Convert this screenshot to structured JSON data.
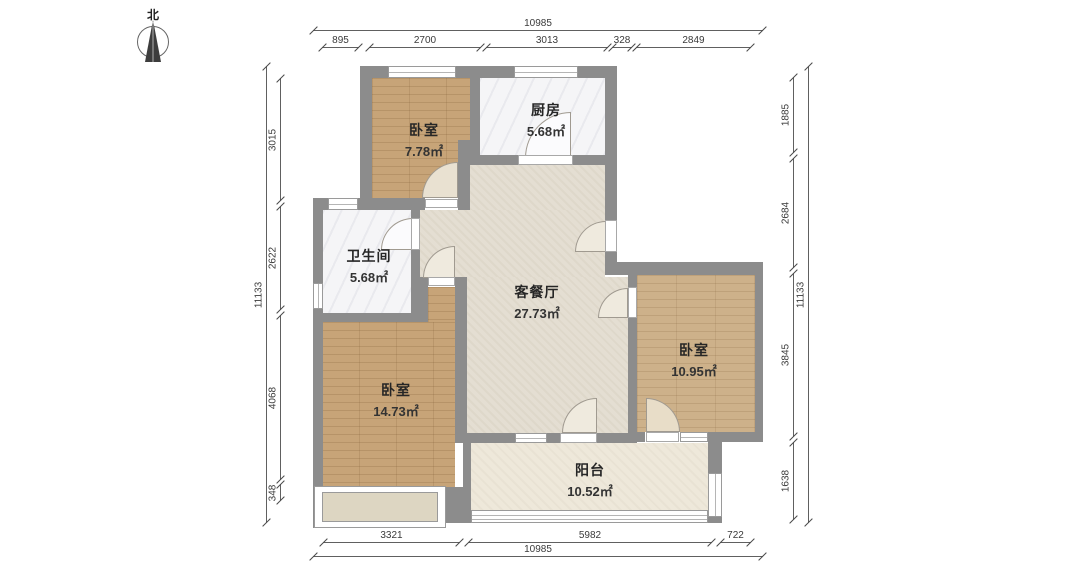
{
  "title": "apartment-floor-plan",
  "north": {
    "label": "北"
  },
  "rooms": [
    {
      "id": "bedroom-top",
      "name": "卧室",
      "area": "7.78㎡",
      "floor": "wood"
    },
    {
      "id": "kitchen",
      "name": "厨房",
      "area": "5.68㎡",
      "floor": "marble"
    },
    {
      "id": "bathroom",
      "name": "卫生间",
      "area": "5.68㎡",
      "floor": "marble"
    },
    {
      "id": "living-dining",
      "name": "客餐厅",
      "area": "27.73㎡",
      "floor": "beige-tile"
    },
    {
      "id": "bedroom-left",
      "name": "卧室",
      "area": "14.73㎡",
      "floor": "wood"
    },
    {
      "id": "bedroom-right",
      "name": "卧室",
      "area": "10.95㎡",
      "floor": "wood"
    },
    {
      "id": "balcony",
      "name": "阳台",
      "area": "10.52㎡",
      "floor": "cream-tile"
    }
  ],
  "dimensions": {
    "top": {
      "total": "10985",
      "segments": [
        "895",
        "2700",
        "3013",
        "328",
        "2849"
      ]
    },
    "bottom": {
      "total": "10985",
      "segments": [
        "3321",
        "5982",
        "722"
      ]
    },
    "left": {
      "total": "11133",
      "segments": [
        "3015",
        "2622",
        "4068",
        "348"
      ]
    },
    "right": {
      "total": "11133",
      "segments": [
        "1885",
        "2684",
        "3845",
        "1638"
      ]
    }
  },
  "colors": {
    "wall": "#8c8c8c",
    "wood_floor": "#c7a478",
    "wood_floor_light": "#cdb18a",
    "marble_floor": "#f5f5f7",
    "living_floor": "#e4ded2",
    "balcony_floor": "#eee8da",
    "dimension_line": "#606060",
    "label_text": "#262626"
  }
}
